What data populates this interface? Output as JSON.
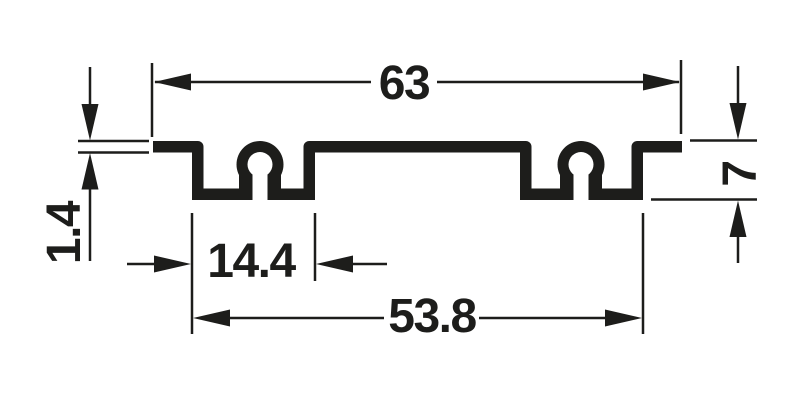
{
  "colors": {
    "background": "#ffffff",
    "ink": "#1d1d1b"
  },
  "drawing": {
    "type": "extrusion-profile-cross-section",
    "dimensions": {
      "overall_width": "63",
      "material_thickness": "1.4",
      "profile_height": "7",
      "channel_width": "14.4",
      "channel_outer_span": "53.8"
    }
  }
}
